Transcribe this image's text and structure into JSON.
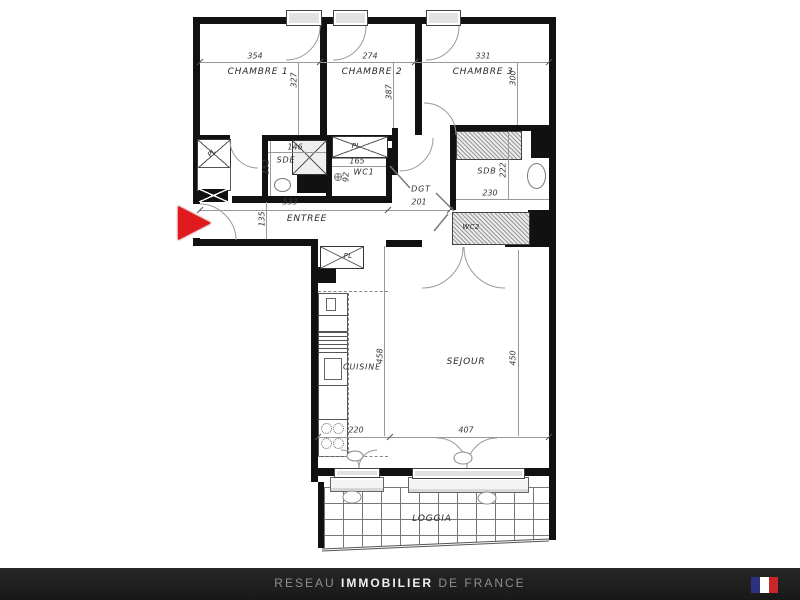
{
  "plan": {
    "rooms": {
      "chambre1": {
        "label": "CHAMBRE 1",
        "width": "354",
        "depth": "327"
      },
      "chambre2": {
        "label": "CHAMBRE 2",
        "width": "274",
        "depth": "387"
      },
      "chambre3": {
        "label": "CHAMBRE 3",
        "width": "331",
        "depth": "300"
      },
      "sde": {
        "label": "SDE",
        "width": "146",
        "depth": "152"
      },
      "wc1": {
        "label": "WC1",
        "width": "165",
        "level": "92"
      },
      "dgt": {
        "label": "DGT",
        "width": "201"
      },
      "sdb": {
        "label": "SDB",
        "width": "230",
        "depth": "222"
      },
      "wc2": {
        "label": "WC2"
      },
      "entree": {
        "label": "ENTREE",
        "width": "533",
        "depth": "135"
      },
      "cuisine": {
        "label": "CUISINE",
        "width": "220",
        "depth": "458"
      },
      "sejour": {
        "label": "SEJOUR",
        "width": "407",
        "depth": "450"
      },
      "loggia": {
        "label": "LOGGIA"
      },
      "closet": {
        "label": "PL"
      }
    },
    "colors": {
      "wall": "#111111",
      "dimension_line": "#999999",
      "entrance_arrow": "#e01a1d"
    }
  },
  "footer": {
    "brand": {
      "prefix": "RESEAU",
      "main": "IMMOBILIER",
      "suffix": "DE FRANCE"
    },
    "background": "#1d1d1d",
    "flag": {
      "blue": "#2b3280",
      "white": "#ffffff",
      "red": "#c8262b"
    }
  }
}
